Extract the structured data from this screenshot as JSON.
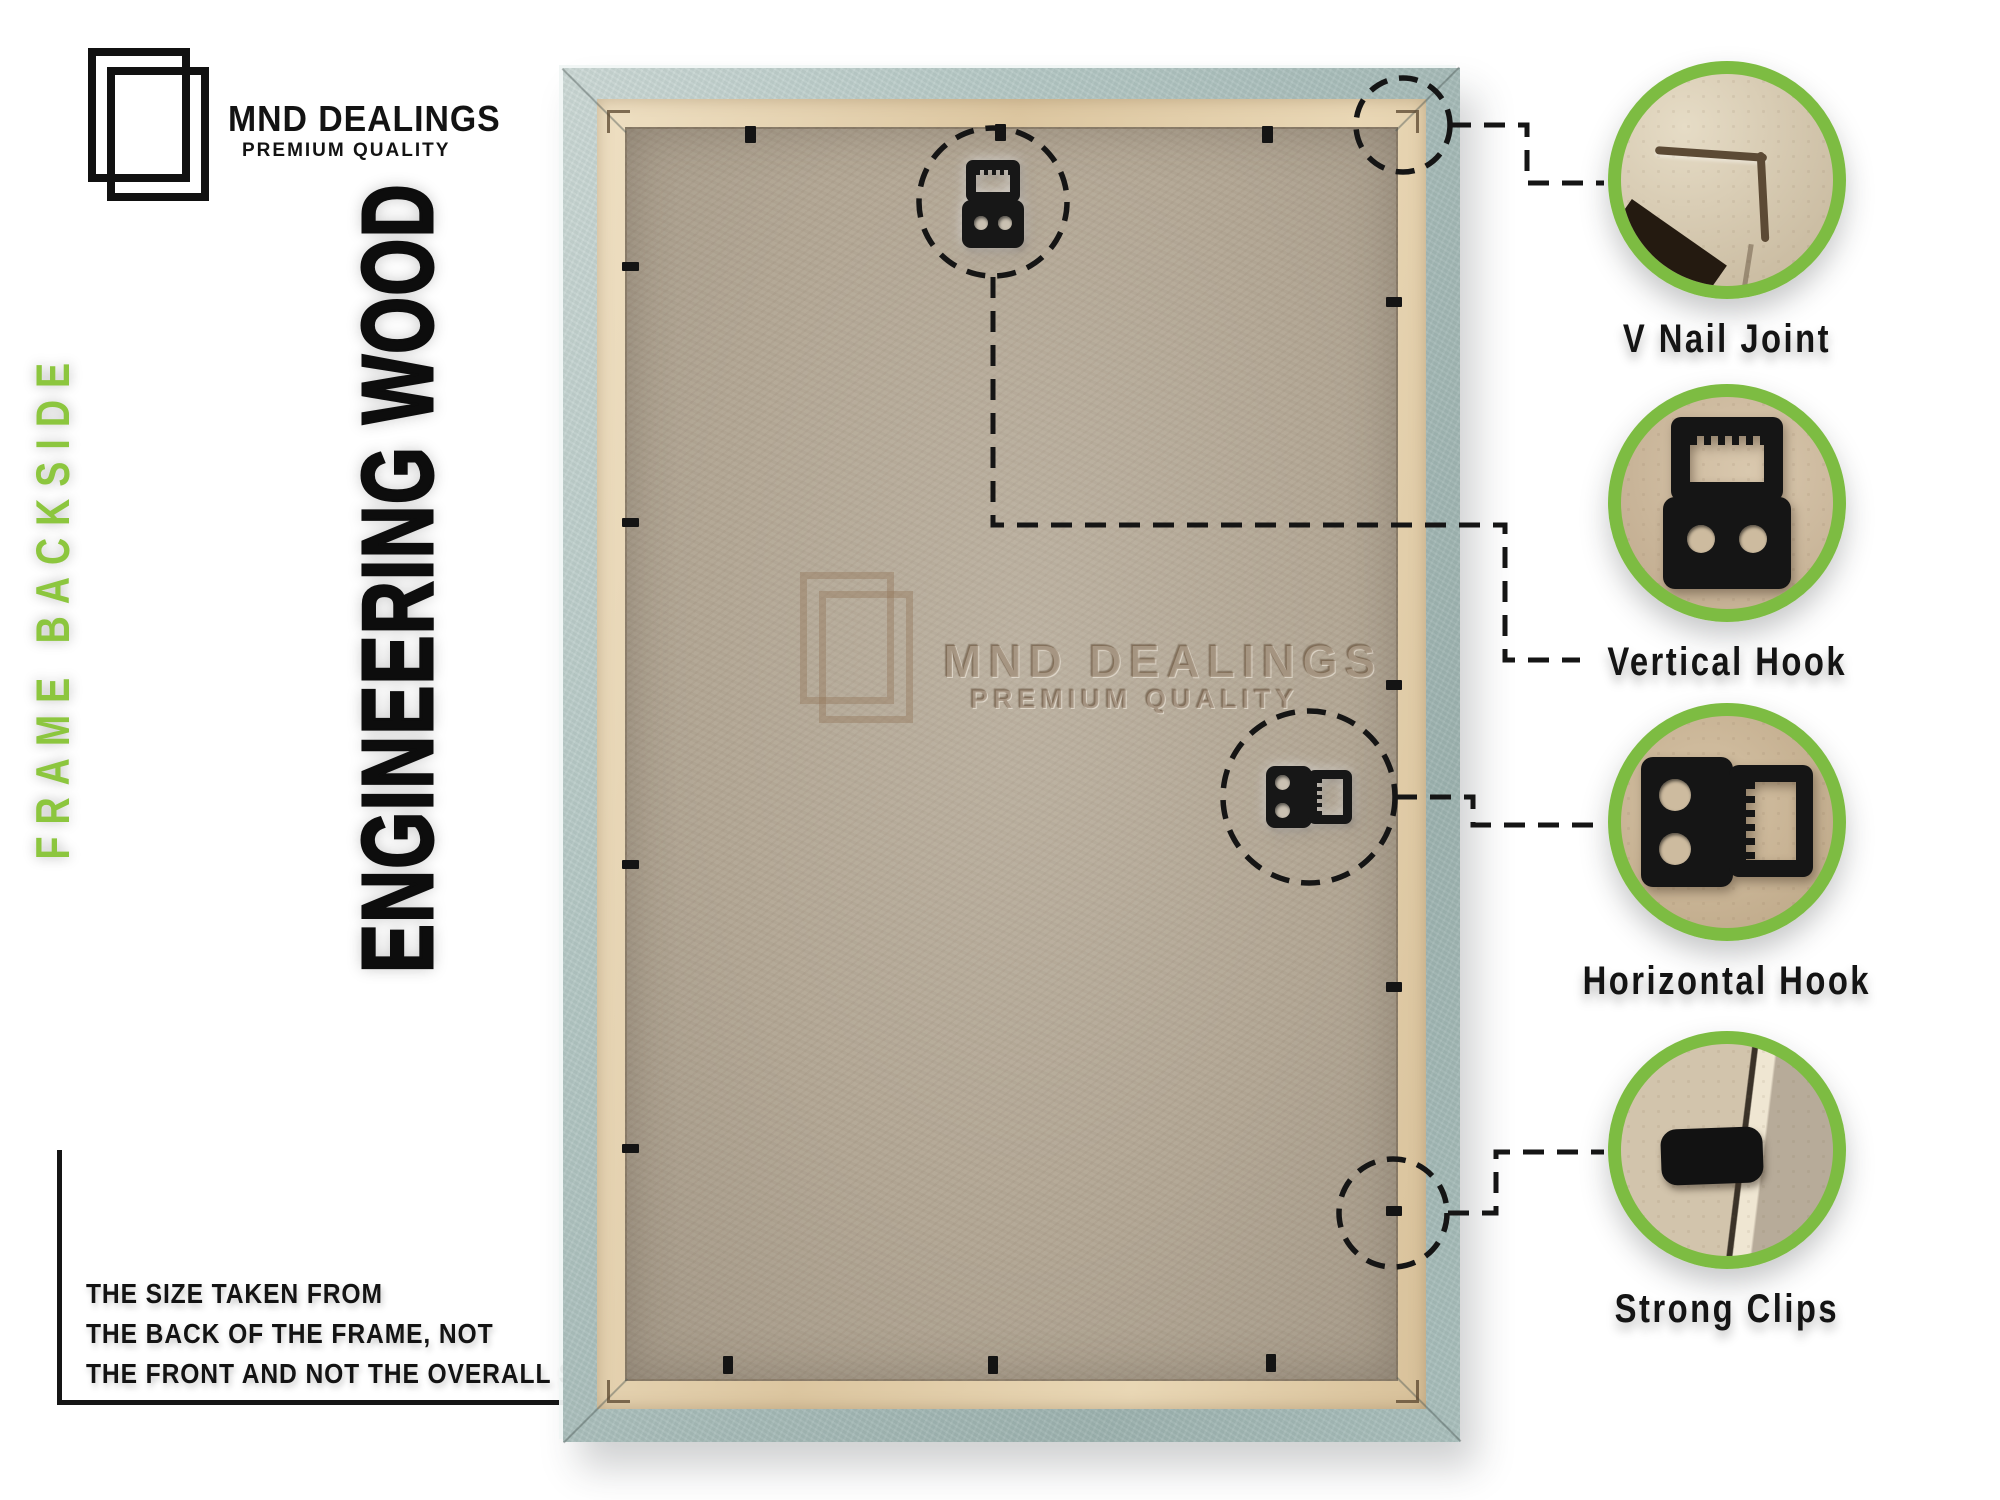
{
  "brand": {
    "logo_icon": "overlapping-frames",
    "name": "MND DEALINGS",
    "tagline": "PREMIUM QUALITY"
  },
  "left_panel": {
    "side_label": "FRAME BACKSIDE",
    "material_label": "ENGINEERING WOOD",
    "size_note": {
      "line1": "THE SIZE TAKEN FROM",
      "line2": "THE BACK OF THE FRAME, NOT",
      "line3": "THE FRONT AND NOT THE OVERALL SIZE."
    }
  },
  "frame_photo": {
    "subject": "picture-frame-backside",
    "watermark": {
      "name": "MND DEALINGS",
      "tagline": "PREMIUM QUALITY"
    },
    "hardware": [
      "vertical-hook",
      "horizontal-hook",
      "retaining-clips",
      "v-nail-corner-joints"
    ]
  },
  "callouts": [
    {
      "id": "v-nail-joint",
      "icon": "v-nail-joint-photo",
      "label": "V Nail Joint"
    },
    {
      "id": "vertical-hook",
      "icon": "vertical-hook-photo",
      "label": "Vertical Hook"
    },
    {
      "id": "horizontal-hook",
      "icon": "horizontal-hook-photo",
      "label": "Horizontal Hook"
    },
    {
      "id": "strong-clips",
      "icon": "strong-clip-photo",
      "label": "Strong Clips"
    }
  ],
  "colors": {
    "accent_green": "#7dbc42",
    "side_label_green": "#8cc63e",
    "frame_blue": "#aec3c0",
    "lip_cream": "#e6d3ae",
    "board_tan": "#b0a595",
    "hardware_black": "#151515",
    "text_black": "#131313"
  }
}
